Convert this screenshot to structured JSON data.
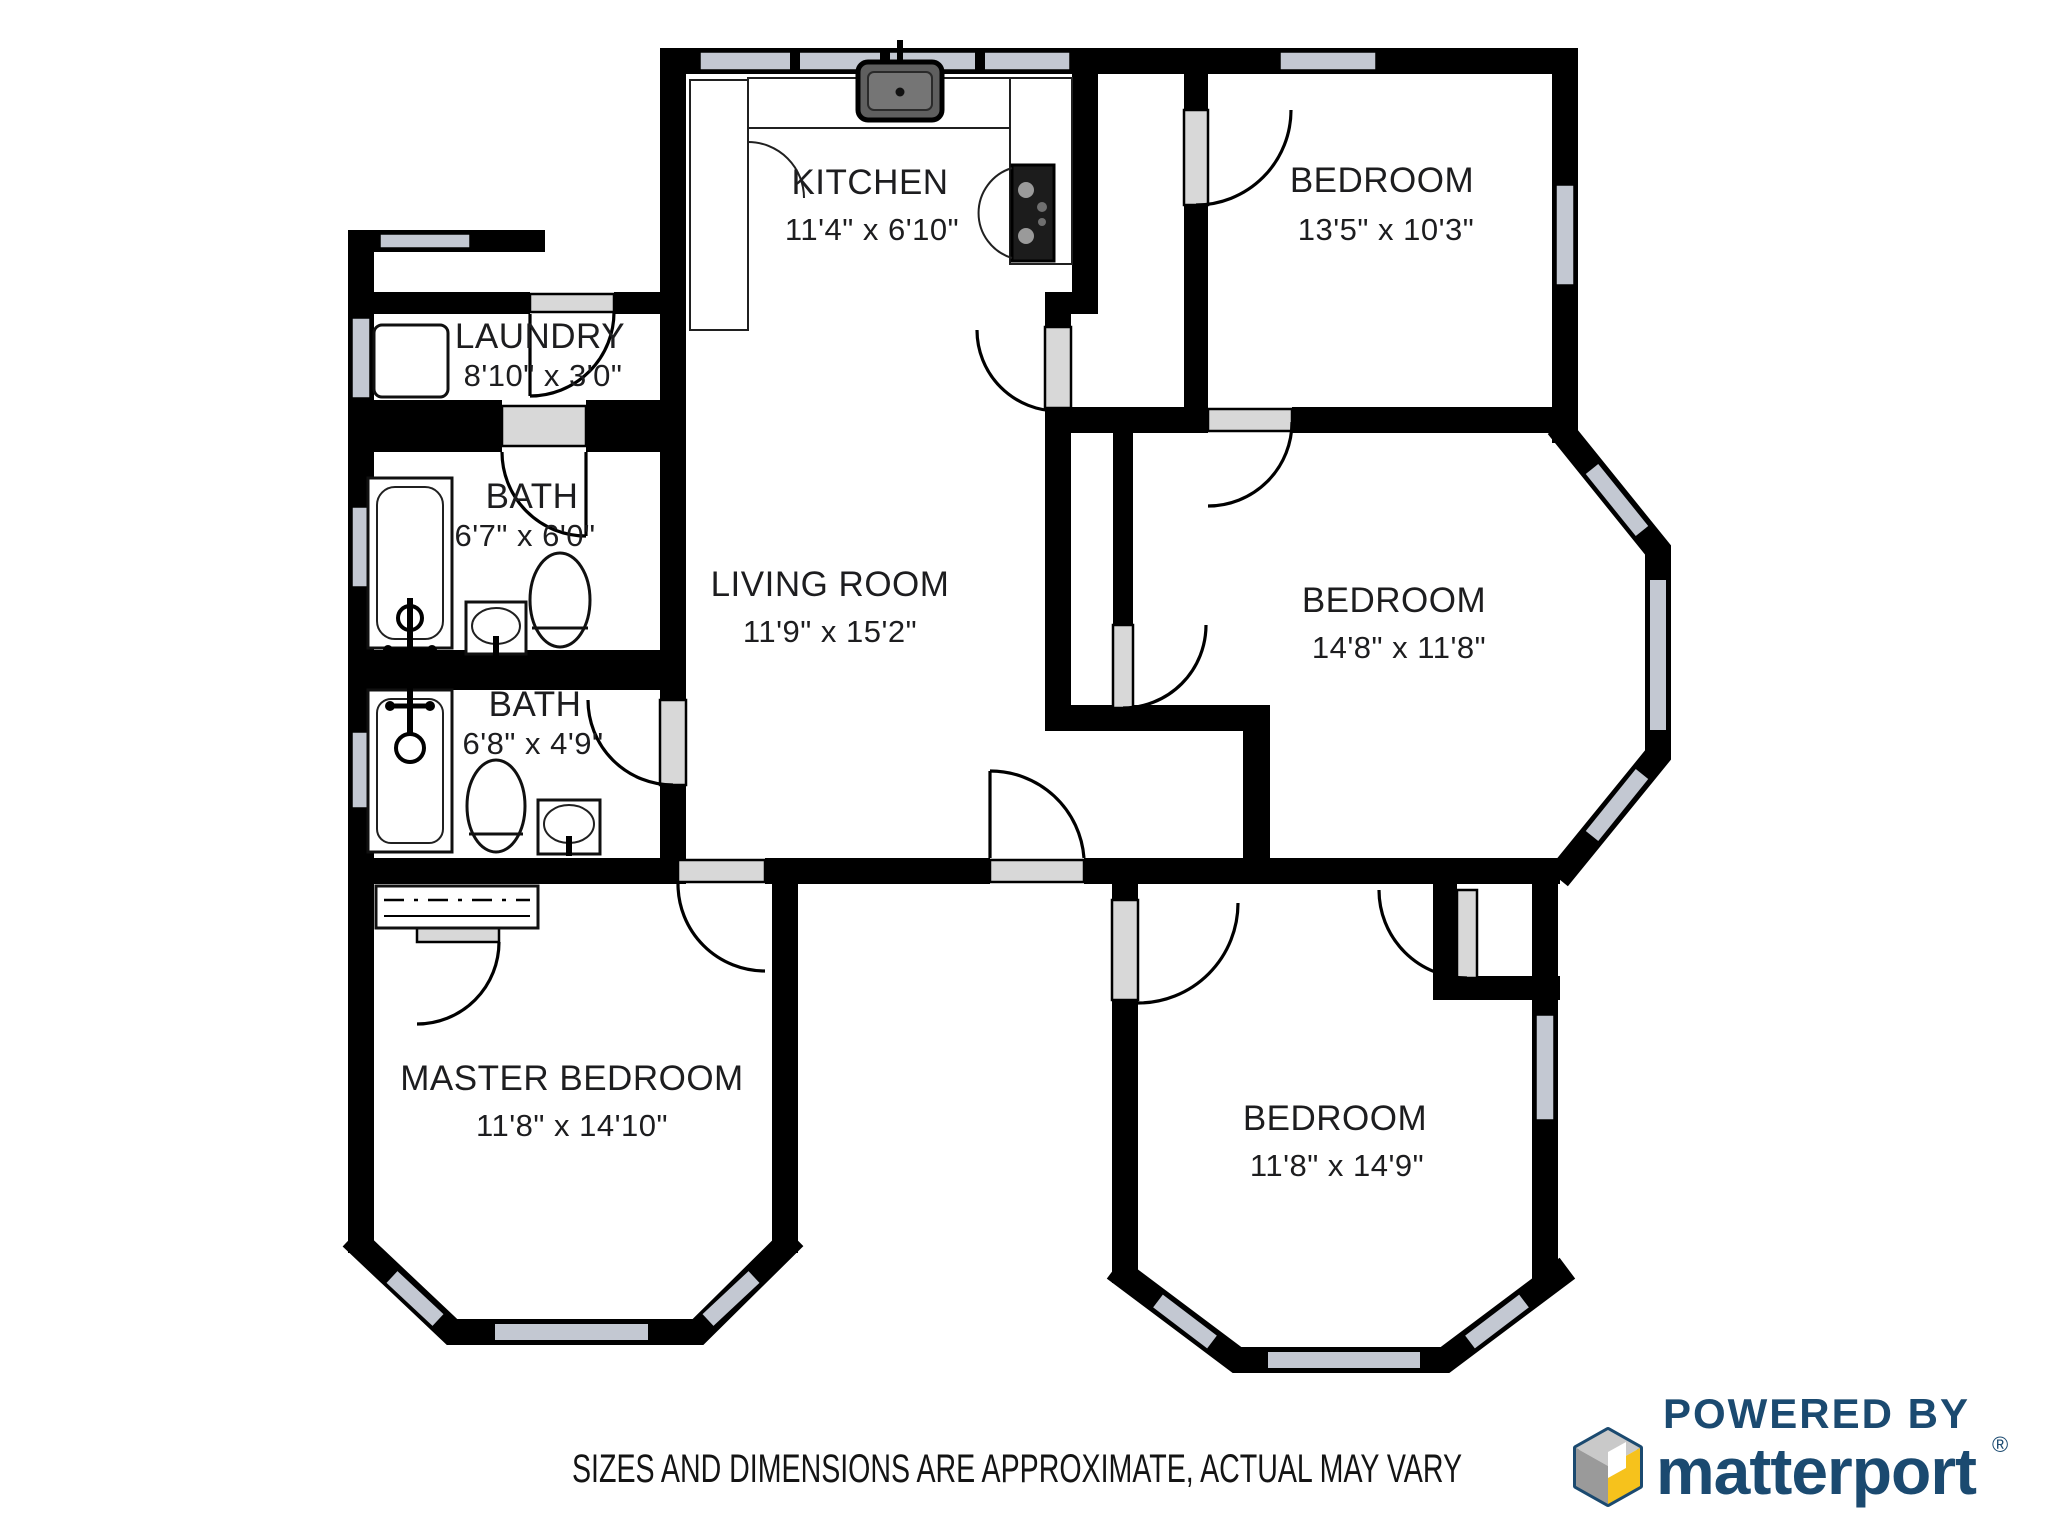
{
  "rooms": [
    {
      "key": "kitchen",
      "name": "KITCHEN",
      "dims": "11'4\" x 6'10\""
    },
    {
      "key": "bedroom_top_right",
      "name": "BEDROOM",
      "dims": "13'5\" x 10'3\""
    },
    {
      "key": "laundry",
      "name": "LAUNDRY",
      "dims": "8'10\" x 3'0\""
    },
    {
      "key": "bath_upper",
      "name": "BATH",
      "dims": "6'7\" x 6'0\""
    },
    {
      "key": "living_room",
      "name": "LIVING ROOM",
      "dims": "11'9\" x 15'2\""
    },
    {
      "key": "bedroom_mid_right",
      "name": "BEDROOM",
      "dims": "14'8\" x 11'8\""
    },
    {
      "key": "bath_lower",
      "name": "BATH",
      "dims": "6'8\" x 4'9\""
    },
    {
      "key": "master_bedroom",
      "name": "MASTER BEDROOM",
      "dims": "11'8\" x 14'10\""
    },
    {
      "key": "bedroom_bottom_right",
      "name": "BEDROOM",
      "dims": "11'8\" x 14'9\""
    }
  ],
  "footer": {
    "disclaimer": "SIZES AND DIMENSIONS ARE APPROXIMATE, ACTUAL MAY VARY"
  },
  "branding": {
    "powered_by": "POWERED BY",
    "brand": "matterport",
    "registered": "®"
  },
  "colors": {
    "wall": "#000000",
    "window": "#c3c8d2",
    "door_panel": "#d8d8d8",
    "label_text": "#1d1d1f",
    "brand_navy": "#1b4a70",
    "brand_yellow": "#f6c21c",
    "brand_gray_light": "#c9c9c9",
    "brand_gray_dark": "#9a9a9a"
  }
}
